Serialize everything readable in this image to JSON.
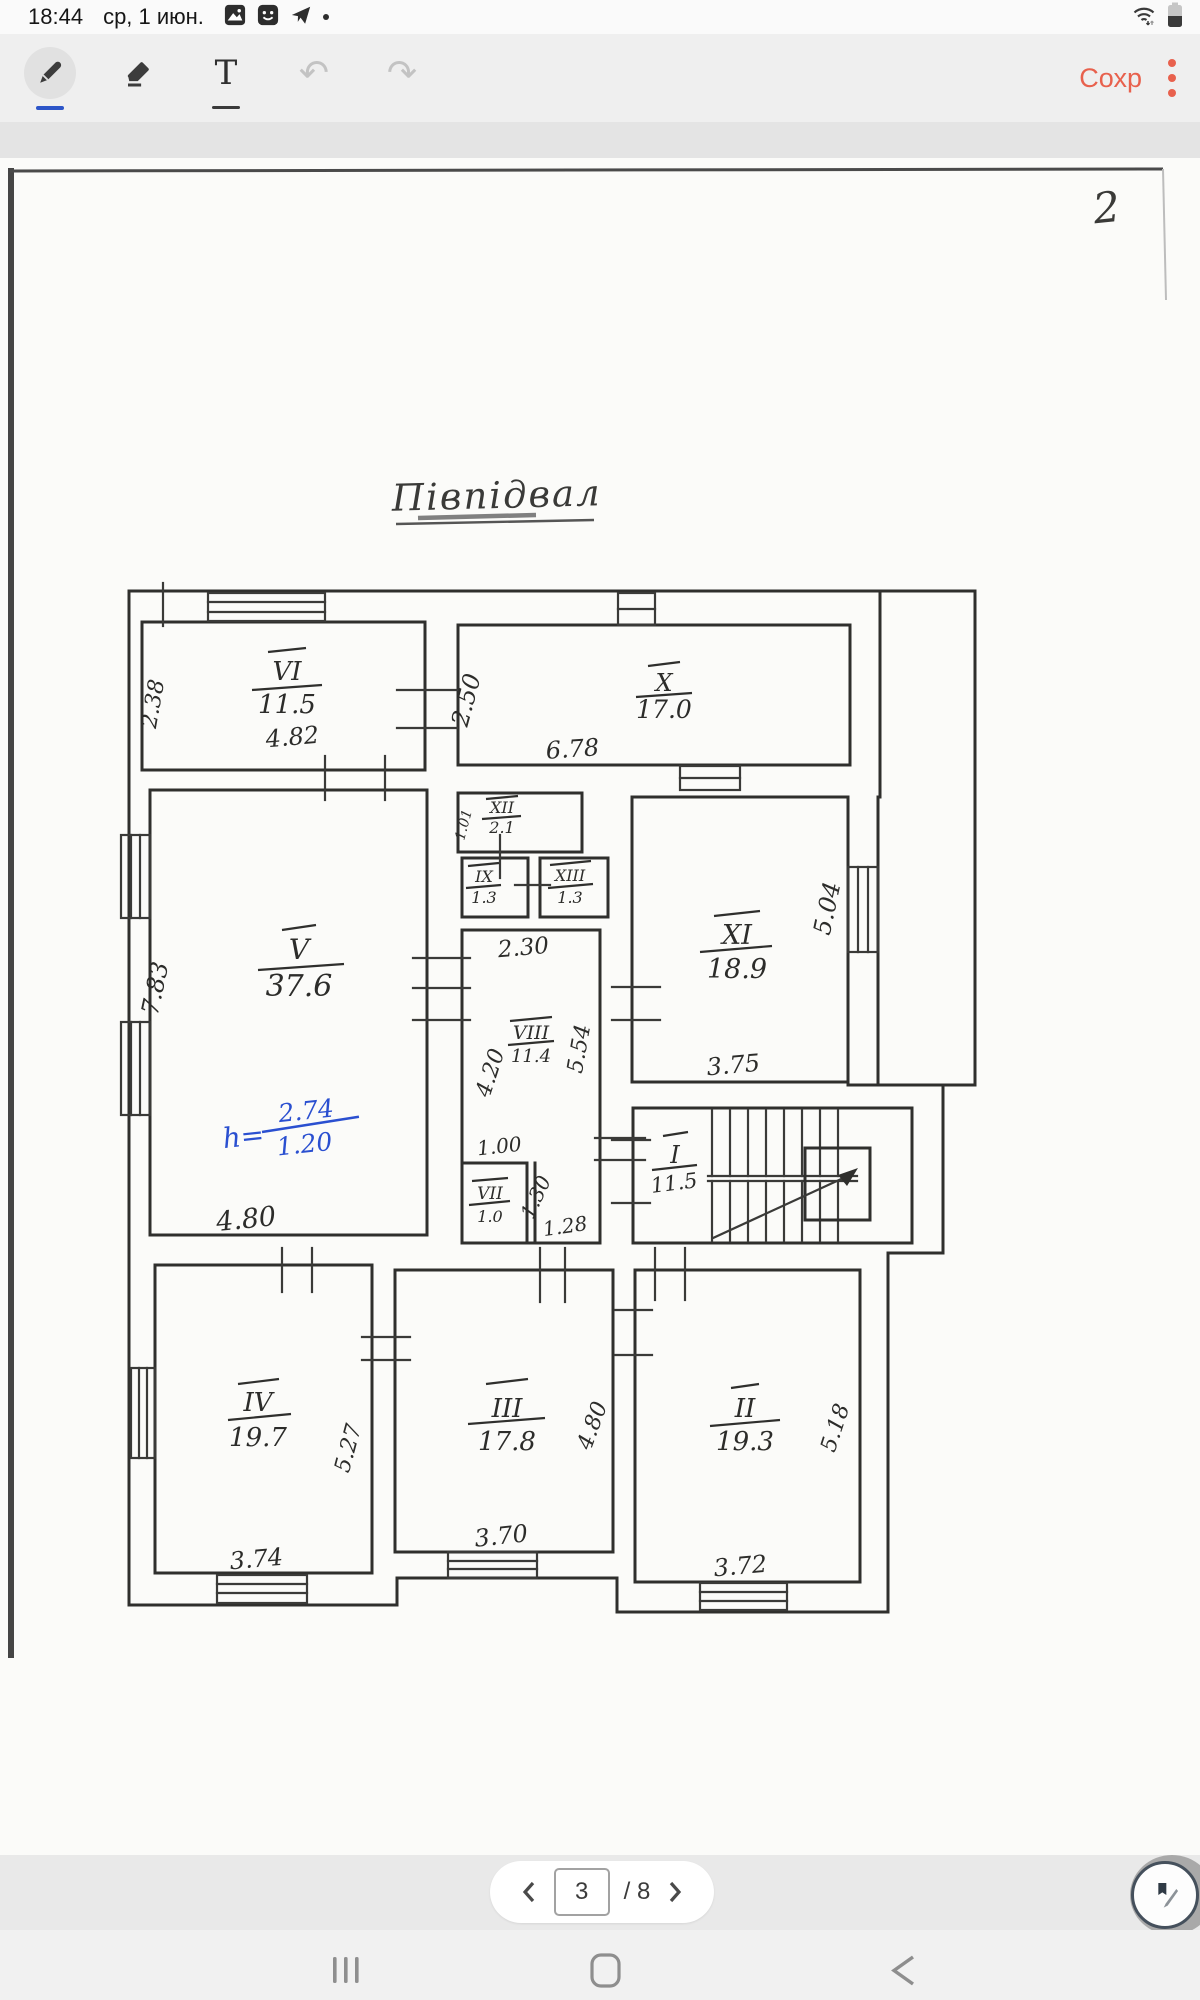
{
  "status_bar": {
    "time": "18:44",
    "date": "ср, 1 июн."
  },
  "toolbar": {
    "save": "Сохр",
    "text_tool_glyph": "T",
    "undo_glyph": "↶",
    "redo_glyph": "↷"
  },
  "pagination": {
    "current": "3",
    "total_label": "/ 8"
  },
  "scan": {
    "corner_number": "2",
    "title": "Півпідвал",
    "rooms": {
      "vi": {
        "num": "VI",
        "area": "11.5"
      },
      "x": {
        "num": "X",
        "area": "17.0"
      },
      "v": {
        "num": "V",
        "area": "37.6"
      },
      "xii": {
        "num": "XII",
        "area": "2.1"
      },
      "ix": {
        "num": "IX",
        "area": "1.3"
      },
      "xiii": {
        "num": "XIII",
        "area": "1.3"
      },
      "viii": {
        "num": "VIII",
        "area": "11.4"
      },
      "vii": {
        "num": "VII",
        "area": "1.0"
      },
      "xi": {
        "num": "XI",
        "area": "18.9"
      },
      "i": {
        "num": "I",
        "area": "11.5"
      },
      "iv": {
        "num": "IV",
        "area": "19.7"
      },
      "iii": {
        "num": "III",
        "area": "17.8"
      },
      "ii": {
        "num": "II",
        "area": "19.3"
      }
    },
    "dims": {
      "vi_w": "4.82",
      "vi_h": "2.38",
      "x_w": "6.78",
      "x_h": "2.50",
      "v_w": "4.80",
      "v_h": "7.83",
      "xii_h": "1.01",
      "hall_w": "2.30",
      "viii_h_l": "4.20",
      "viii_h_r": "5.54",
      "pass_w": "1.00",
      "vii_diag": "1.30",
      "vii_w": "1.28",
      "xi_w": "3.75",
      "xi_h": "5.04",
      "iv_w": "3.74",
      "iv_h": "5.27",
      "iii_w": "3.70",
      "iii_h": "4.80",
      "ii_w": "3.72",
      "ii_h": "5.18"
    },
    "note": {
      "lead": "h=",
      "numerator": "2.74",
      "denominator": "1.20"
    }
  },
  "colors": {
    "accent": "#e8614d",
    "ink": "#2f2f2d",
    "note_blue": "#2a4fd0"
  }
}
